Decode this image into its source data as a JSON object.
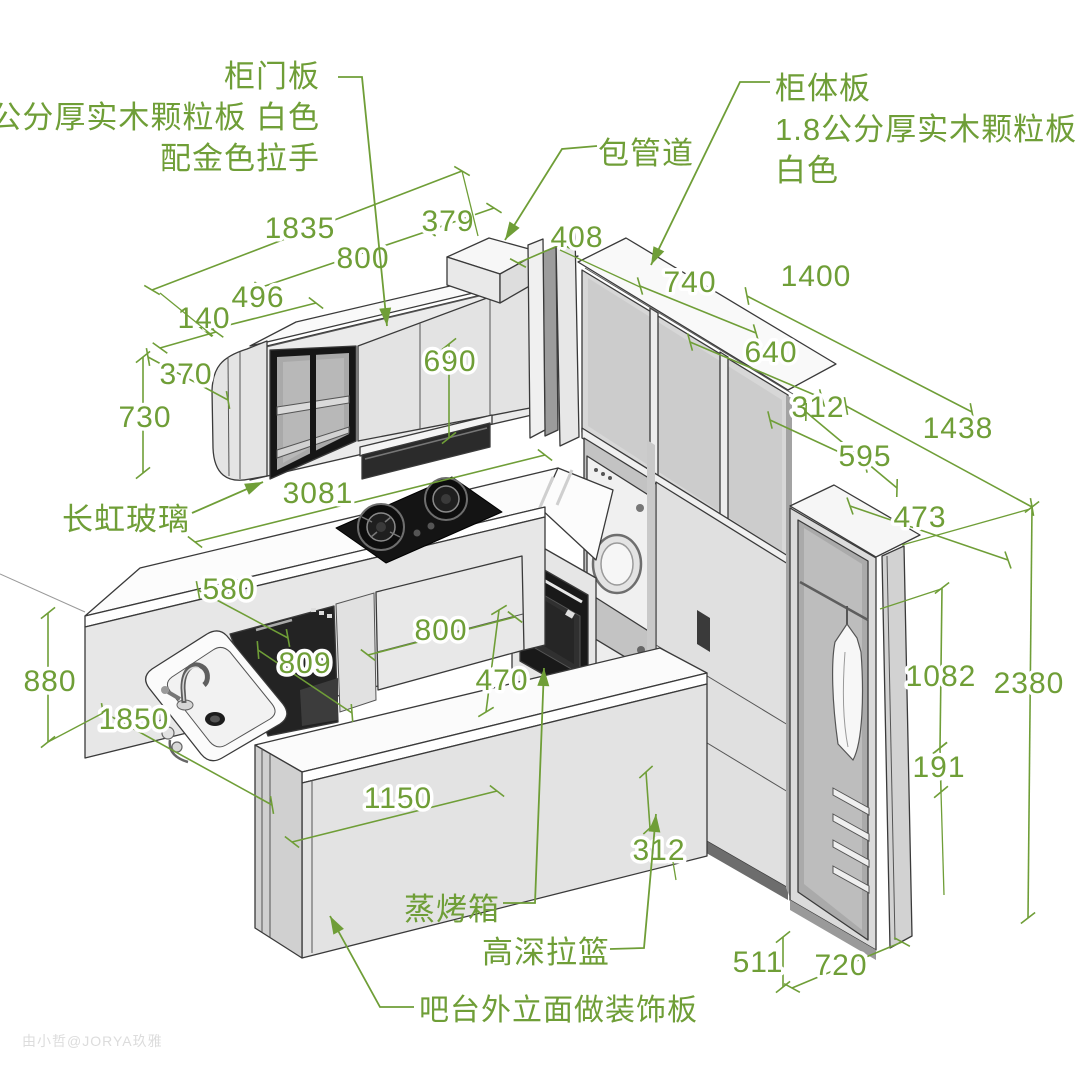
{
  "annotations": {
    "door_panel": {
      "line1": "柜门板",
      "line2": "2公分厚实木颗粒板 白色",
      "line3": "配金色拉手"
    },
    "pipe_duct": {
      "label": "包管道"
    },
    "cabinet_body": {
      "line1": "柜体板",
      "line2": "1.8公分厚实木颗粒板",
      "line3": "白色"
    },
    "reeded_glass": {
      "label": "长虹玻璃"
    },
    "steam_oven": {
      "label": "蒸烤箱"
    },
    "pullout_basket": {
      "label": "高深拉篮"
    },
    "bar_panel": {
      "label": "吧台外立面做装饰板"
    }
  },
  "dimensions": {
    "upper_run_total": "1835",
    "upper_door_section": "800",
    "pipe_box_width": "379",
    "open_shelf_width": "496",
    "end_cabinet_width": "140",
    "upper_cabinet_depth": "370",
    "upper_cabinet_height": "730",
    "door_height": "690",
    "corner_gap": "408",
    "right_section1": "740",
    "right_upper_total": "1400",
    "right_section2": "640",
    "right_section3": "312",
    "right_run_total": "1438",
    "wardrobe_top_depth": "595",
    "wardrobe_front_width": "473",
    "counter_run_length": "3081",
    "counter_depth": "580",
    "base_drawer_width": "800",
    "dishwasher_width": "809",
    "corner_clearance": "470",
    "bar_height": "880",
    "base_run_length": "1850",
    "bar_length": "1150",
    "hanging_height": "1082",
    "drawer_gap": "191",
    "total_height": "2380",
    "base_niche_width": "312",
    "plinth_height": "511",
    "wardrobe_width": "720"
  },
  "watermark": "由小哲@JORYA玖雅",
  "colors": {
    "annotation_green": "#6f9e37",
    "line_dark": "#3a3a3a",
    "appliance_dark": "#1d1d1d"
  }
}
